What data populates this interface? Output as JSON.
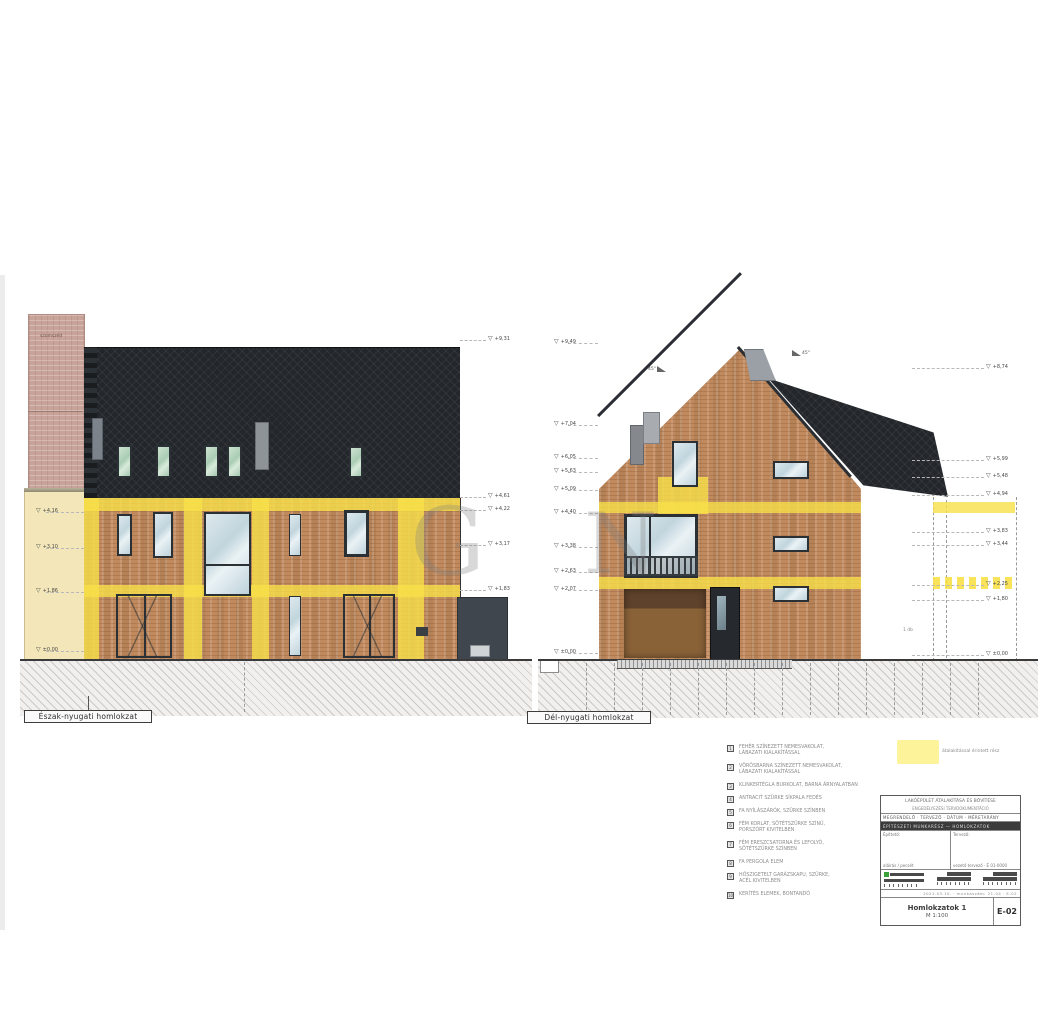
{
  "watermark": {
    "letter_left": "G",
    "letter_right": "N"
  },
  "elevations": {
    "northwest": {
      "label": "Észak-nyugati homlokzat",
      "neighbor_note": "szomszéd"
    },
    "southwest": {
      "label": "Dél-nyugati homlokzat",
      "pitch_left": "45°",
      "pitch_right": "45°",
      "wall_note": "1 db"
    }
  },
  "levels": {
    "northwest_left": [
      {
        "y": 512,
        "label": "+4,16"
      },
      {
        "y": 548,
        "label": "+3,10"
      },
      {
        "y": 592,
        "label": "+1,86"
      },
      {
        "y": 651,
        "label": "±0,00"
      }
    ],
    "northwest_right": [
      {
        "y": 340,
        "label": "+9,31"
      },
      {
        "y": 497,
        "label": "+4,61"
      },
      {
        "y": 510,
        "label": "+4,22"
      },
      {
        "y": 545,
        "label": "+3,17"
      },
      {
        "y": 590,
        "label": "+1,83"
      }
    ],
    "southwest_left": [
      {
        "y": 343,
        "label": "+9,49"
      },
      {
        "y": 425,
        "label": "+7,04"
      },
      {
        "y": 458,
        "label": "+6,05"
      },
      {
        "y": 472,
        "label": "+5,63"
      },
      {
        "y": 490,
        "label": "+5,09"
      },
      {
        "y": 513,
        "label": "+4,40"
      },
      {
        "y": 547,
        "label": "+3,38"
      },
      {
        "y": 572,
        "label": "+2,63"
      },
      {
        "y": 590,
        "label": "+2,07"
      },
      {
        "y": 653,
        "label": "±0,00"
      }
    ],
    "southwest_right": [
      {
        "y": 368,
        "label": "+8,74"
      },
      {
        "y": 460,
        "label": "+5,99"
      },
      {
        "y": 477,
        "label": "+5,48"
      },
      {
        "y": 495,
        "label": "+4,94"
      },
      {
        "y": 532,
        "label": "+3,83"
      },
      {
        "y": 545,
        "label": "+3,44"
      },
      {
        "y": 585,
        "label": "+2,25"
      },
      {
        "y": 600,
        "label": "+1,80"
      },
      {
        "y": 655,
        "label": "±0,00"
      }
    ]
  },
  "legend": {
    "swatch_label": "átalakítással érintett rész",
    "items": [
      {
        "num": "1",
        "lines": [
          "FEHÉR SZÍNEZETT NEMESVAKOLAT,",
          "LÁBAZATI KIALAKÍTÁSSAL"
        ]
      },
      {
        "num": "2",
        "lines": [
          "VÖRÖSBARNA SZÍNEZETT NEMESVAKOLAT,",
          "LÁBAZATI KIALAKÍTÁSSAL"
        ]
      },
      {
        "num": "3",
        "lines": [
          "KLINKERTÉGLA BURKOLAT, BARNA ÁRNYALATBAN"
        ]
      },
      {
        "num": "4",
        "lines": [
          "ANTRACIT SZÜRKE SÍKPALA FEDÉS"
        ]
      },
      {
        "num": "5",
        "lines": [
          "FA NYÍLÁSZÁRÓK, SZÜRKE SZÍNBEN"
        ]
      },
      {
        "num": "6",
        "lines": [
          "FÉM KORLÁT, SÖTÉTSZÜRKE SZÍNŰ,",
          "PORSZÓRT KIVITELBEN"
        ]
      },
      {
        "num": "7",
        "lines": [
          "FÉM ERESZCSATORNA ÉS LEFOLYÓ,",
          "SÖTÉTSZÜRKE SZÍNBEN"
        ]
      },
      {
        "num": "8",
        "lines": [
          "FA PERGOLA ELEM"
        ]
      },
      {
        "num": "9",
        "lines": [
          "HŐSZIGETELT GARÁZSKAPU, SZÜRKE,",
          "ACÉL KIVITELBEN"
        ]
      },
      {
        "num": "10",
        "lines": [
          "KERÍTÉS ELEMEK, BONTANDÓ"
        ]
      }
    ]
  },
  "title_block": {
    "header_line1": "LAKÓÉPÜLET ÁTALAKÍTÁSA ÉS BŐVÍTÉSE",
    "header_line2": "ENGEDÉLYEZÉSI TERVDOKUMENTÁCIÓ",
    "row_small": "MEGRENDELŐ · TERVEZŐ · DÁTUM · MÉRETARÁNY",
    "dark_band": "ÉPÍTÉSZETI MUNKARÉSZ — HOMLOKZATOK",
    "col_left_label": "Építtető:",
    "col_left_lines": "aláírás / pecsét",
    "col_right_label": "Tervező:",
    "col_right_lines": "vezető tervező · É 01-0000",
    "nums_row": "2021.03.10. · munkaszám: 21-04 · E-02",
    "sheet_title": "Homlokzatok 1",
    "sheet_scale": "M 1:100",
    "sheet_code": "E-02"
  }
}
